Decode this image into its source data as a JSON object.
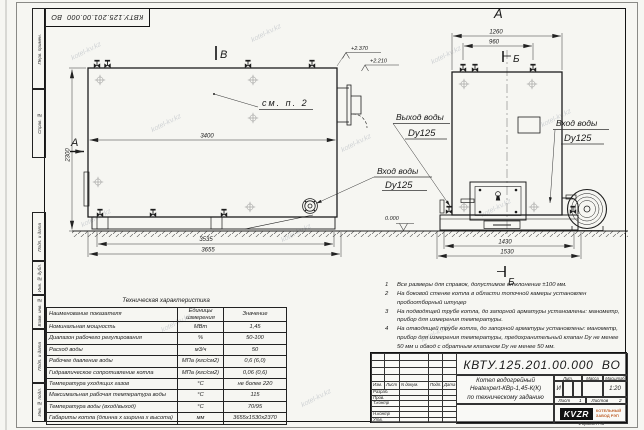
{
  "watermark": {
    "text": "kotel-kv.kz"
  },
  "sheet": {
    "top_stamp": "КВТУ.125.201.00.000  ВО",
    "format_note": "Формат А3"
  },
  "frame": {
    "top_labels": [
      "Перв. примен.",
      "Справ. №"
    ],
    "side_labels": [
      "Подп. и дата",
      "Инв. № дубл.",
      "Взам. инв. №",
      "Подп. и дата",
      "Инв. № подл."
    ]
  },
  "views": {
    "front": {
      "section_label_top": "В",
      "section_label_left": "А",
      "see_note": "см. п. 2",
      "dim_inner": "3400",
      "dim_height": "2300",
      "elev_high": "+2.370",
      "elev_low": "+2.210",
      "dim_base_inner": "3535",
      "dim_base_outer": "3655",
      "inlet_line1": "Вход воды",
      "inlet_line2": "Dy125"
    },
    "side": {
      "view_label": "А",
      "section_label": "Б",
      "dim_top_outer": "1260",
      "dim_top_inner": "960",
      "elev_zero": "0.000",
      "dim_base_inner": "1430",
      "dim_base_outer": "1530",
      "outlet_line1": "Выход воды",
      "outlet_line2": "Dy125",
      "inlet_line1": "Вход воды",
      "inlet_line2": "Dy125"
    }
  },
  "notes": {
    "items": [
      {
        "num": "1",
        "text": "Все размеры для справок, допустимое отклонение ±100 мм."
      },
      {
        "num": "2",
        "text": "На боковой стенке котла в области топочной камеры установлен пробоотборный штуцер"
      },
      {
        "num": "3",
        "text": "На подводящей трубе котла, до запорной арматуры установлены: манометр, прибор для измерения температуры."
      },
      {
        "num": "4",
        "text": "На отводящей трубе котла, до запорной арматуры установлены: манометр, прибор для измерения температуры, предохранительный клапан Dу не менее 50 мм и обвод с обратным клапаном Dу не менее 50 мм."
      }
    ]
  },
  "spec_table": {
    "title": "Техническая характеристика",
    "col_name": "Наименование показателя",
    "col_units_l1": "Единицы",
    "col_units_l2": "измерения",
    "col_value": "Значение",
    "rows": [
      {
        "name": "Номинальная мощность",
        "units": "МВт",
        "value": "1,45"
      },
      {
        "name": "Диапазон рабочего регулирования",
        "units": "%",
        "value": "50-100"
      },
      {
        "name": "Расход воды",
        "units": "м3/ч",
        "value": "50"
      },
      {
        "name": "Рабочее давление воды",
        "units": "МПа (кгс/см2)",
        "value": "0,6 (6,0)"
      },
      {
        "name": "Гидравлическое сопротивление котла",
        "units": "МПа (кгс/см2)",
        "value": "0,06 (0,6)"
      },
      {
        "name": "Температура уходящих газов",
        "units": "°С",
        "value": "не более 220"
      },
      {
        "name": "Максимальная рабочая температура воды",
        "units": "°С",
        "value": "115"
      },
      {
        "name": "Температура воды (вход/выход)",
        "units": "°С",
        "value": "70/95"
      },
      {
        "name": "Габариты котла (длинна х ширина х высота)",
        "units": "мм",
        "value": "3655х1530х2370"
      }
    ]
  },
  "title_block": {
    "doc_number": "КВТУ.125.201.00.000  ВО",
    "product_line1": "Котел водогрейный",
    "product_line2": "Heatexpert-КВр-1,45-К(К)",
    "product_line3": "по техническому заданию",
    "header": {
      "izm": "Изм.",
      "list": "Лист",
      "doc": "N докум.",
      "podp": "Подп.",
      "data": "Дата"
    },
    "roles": [
      "Разраб.",
      "Пров.",
      "Т.контр",
      "",
      "Н.контр",
      "Утв."
    ],
    "lit_label": "Лит.",
    "lit_value": "И",
    "mass_label": "Масса",
    "scale_label": "Масштаб",
    "scale_value": "1:20",
    "sheet_label": "Лист",
    "sheet_value": "1",
    "sheets_label": "Листов",
    "sheets_value": "2",
    "logo_text": "KVZR",
    "company_line1": "КОТЕЛЬНЫЙ",
    "company_line2": "ЗАВОД РЭП"
  }
}
